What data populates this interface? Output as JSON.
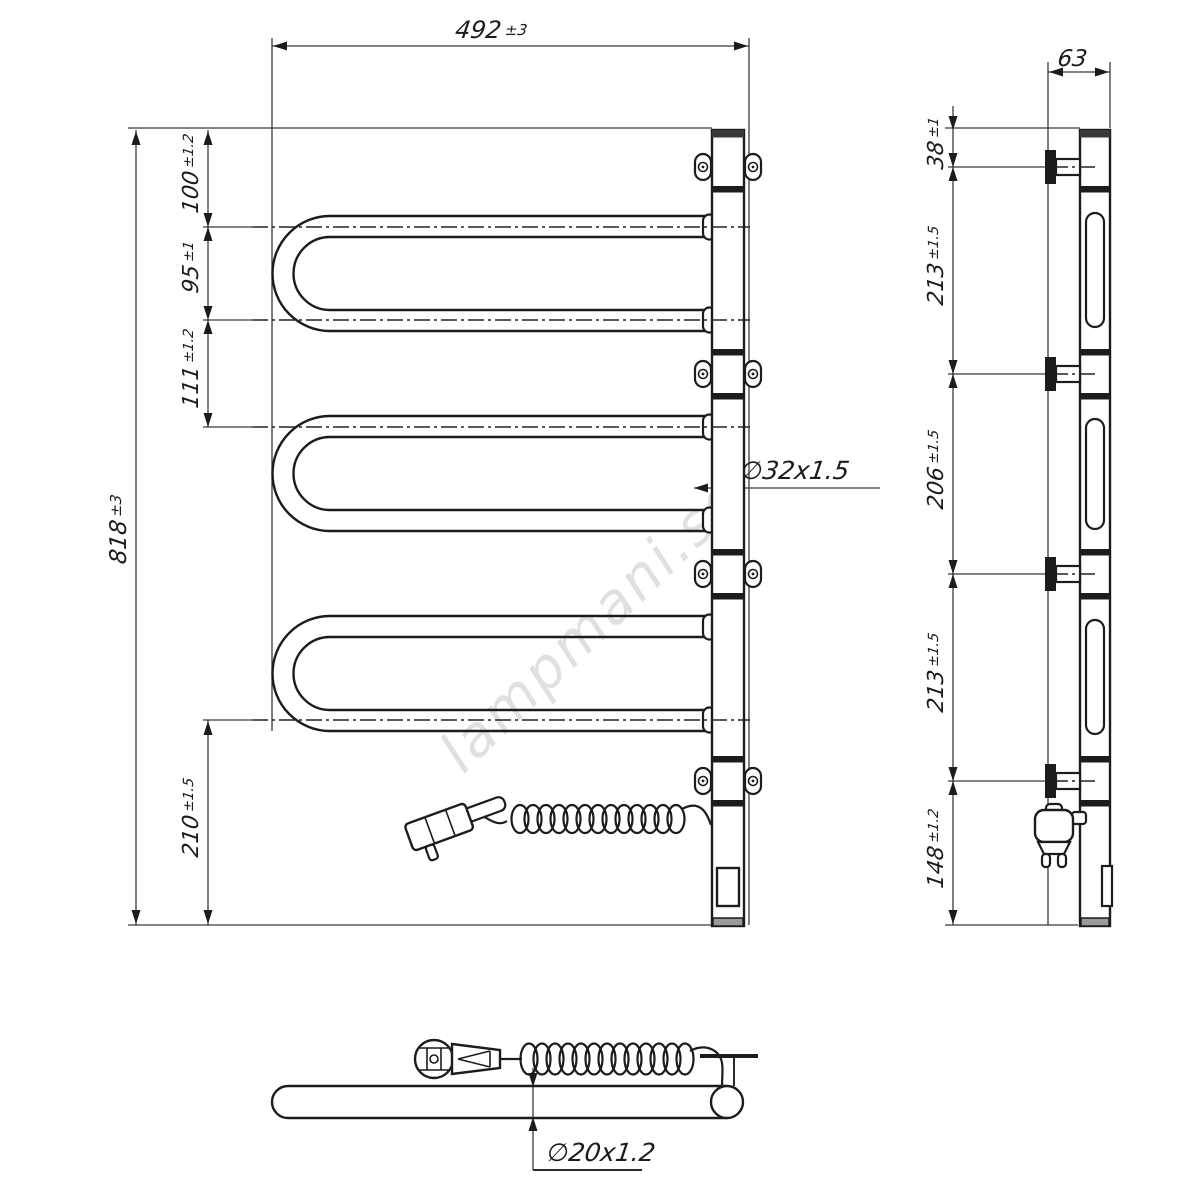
{
  "watermark": "lampmani.se",
  "front_view": {
    "dims": {
      "width": {
        "value": "492",
        "tol": "±3"
      },
      "height": {
        "value": "818",
        "tol": "±3"
      },
      "top_offset": {
        "value": "100",
        "tol": "±1.2"
      },
      "tube_pitch": {
        "value": "95",
        "tol": "±1"
      },
      "loop_gap": {
        "value": "111",
        "tol": "±1.2"
      },
      "bottom_offset": {
        "value": "210",
        "tol": "±1.5"
      },
      "collector_diameter": "∅32x1.5"
    }
  },
  "side_view": {
    "dims": {
      "depth": {
        "value": "63",
        "tol": ""
      },
      "top_offset": {
        "value": "38",
        "tol": "±1"
      },
      "bracket_span_upper": {
        "value": "213",
        "tol": "±1.5"
      },
      "bracket_span_middle": {
        "value": "206",
        "tol": "±1.5"
      },
      "bracket_span_lower": {
        "value": "213",
        "tol": "±1.5"
      },
      "bottom_offset": {
        "value": "148",
        "tol": "±1.2"
      }
    }
  },
  "bottom_view": {
    "dims": {
      "tube_diameter": "∅20x1.2"
    }
  }
}
